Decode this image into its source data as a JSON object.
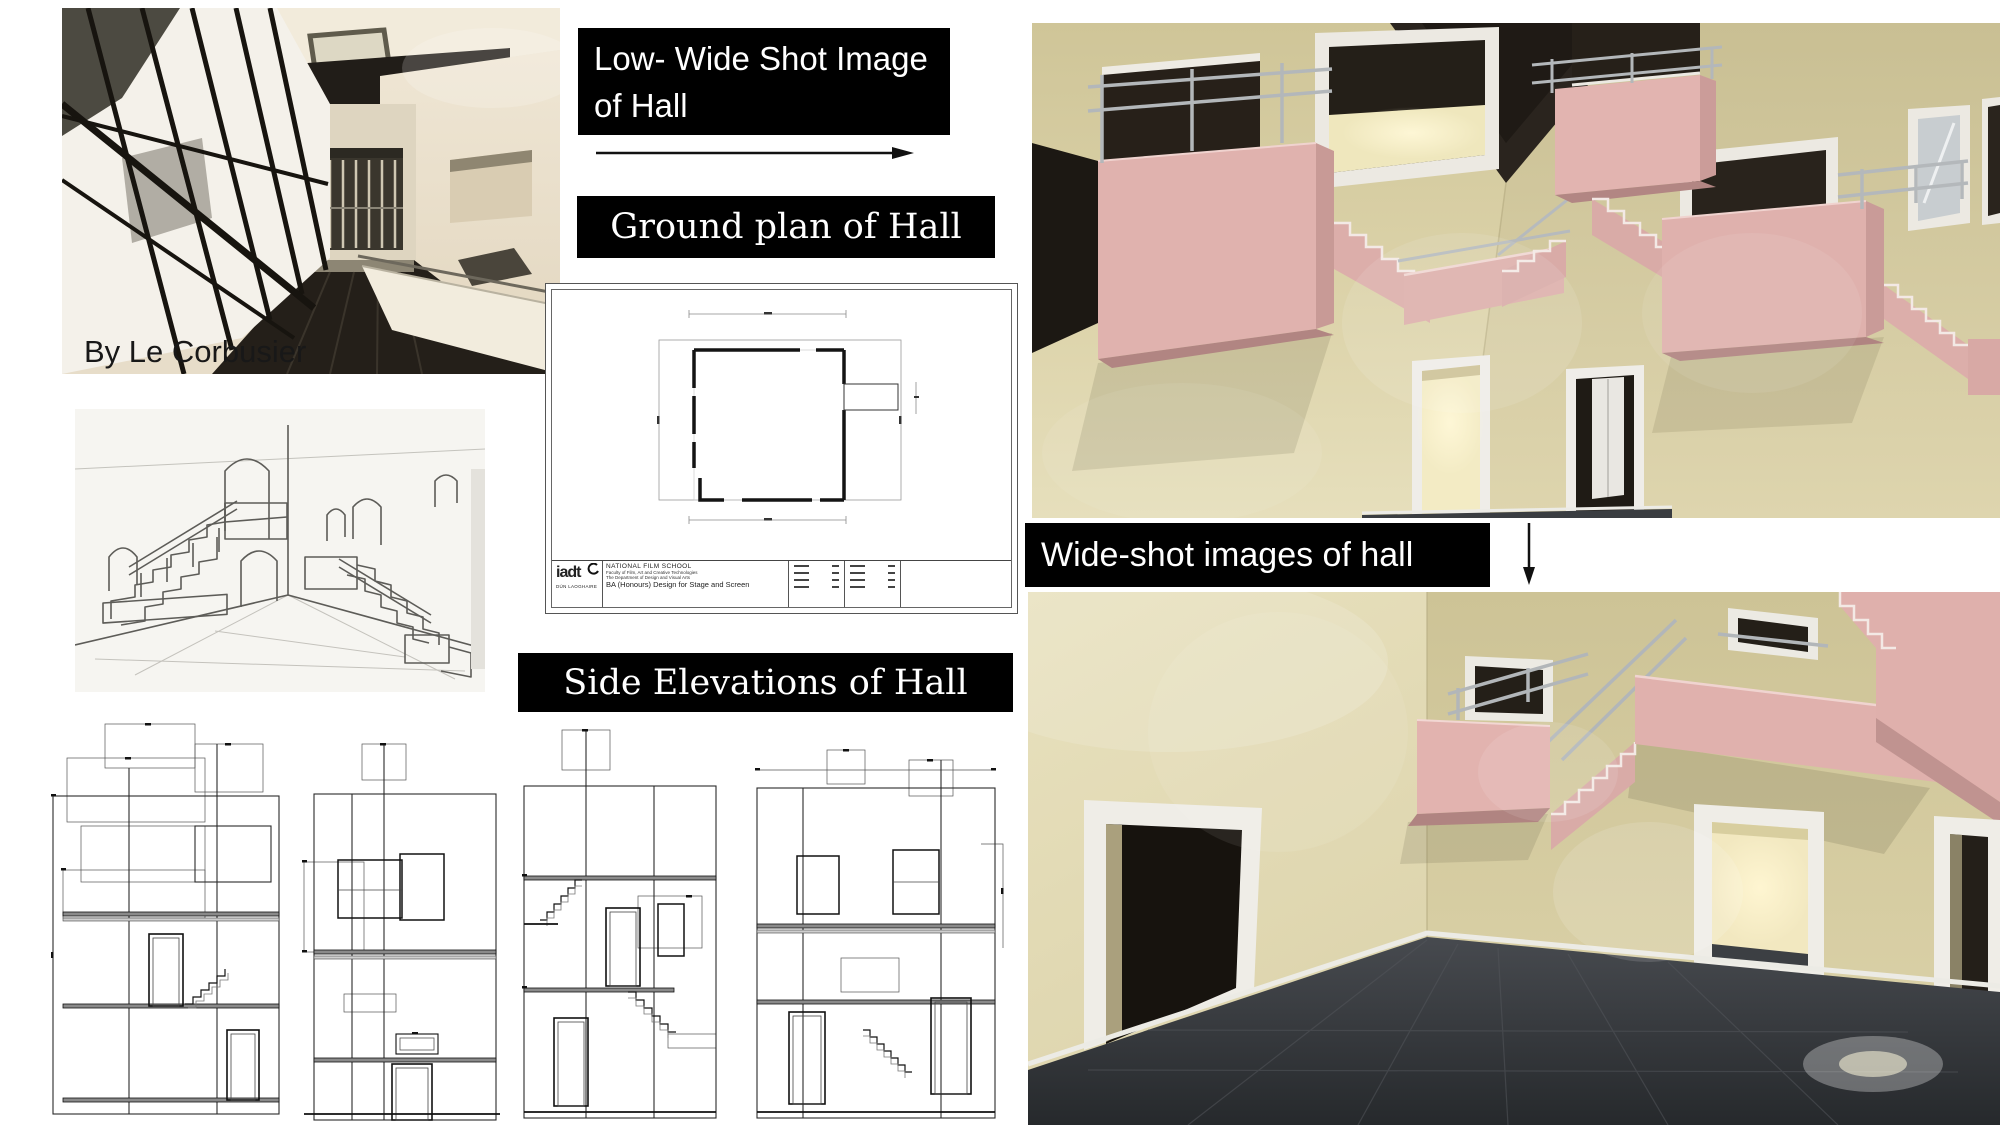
{
  "labels": {
    "low_wide_shot": "Low- Wide Shot Image of Hall",
    "ground_plan": "Ground plan of Hall",
    "side_elevations": "Side Elevations of Hall",
    "wide_shot": "Wide-shot images of hall",
    "photo_credit": "By Le Corbusier"
  },
  "ground_plan_sheet": {
    "title_block": {
      "logo": "iadt",
      "logo_sub": "DÚN LAOGHAIRE",
      "school": "NATIONAL FILM SCHOOL",
      "faculty": "Faculty of Film, Art and Creative Technologies",
      "department": "The Department of Design and Visual Arts",
      "course": "BA (Honours) Design for Stage and Screen"
    }
  },
  "images": {
    "corbusier_photo": "Interior ramp hallway photo by Le Corbusier",
    "stair_sketch": "Pencil sketch of hall staircases with arched doors",
    "render_top": "Low wide shot 3D render of hall with pink staircases",
    "render_bottom": "Wide shot 3D render of hall interior"
  },
  "icons": {
    "right_arrow": "right-arrow",
    "down_arrow": "down-arrow"
  },
  "colors": {
    "label_bg": "#000000",
    "label_text": "#ffffff",
    "wall_beige": "#d8cfa6",
    "stair_pink": "#dfb1ad",
    "ceiling_dark": "#2a241e",
    "floor_dark": "#3b3e42",
    "frame_white": "#efede7",
    "railing_gray": "#b2b6b9",
    "drawing_ink": "#1c1c1c",
    "sketch_stroke": "#5d5c58",
    "photo_cream": "#e7ddc9",
    "photo_floor": "#241f19"
  }
}
